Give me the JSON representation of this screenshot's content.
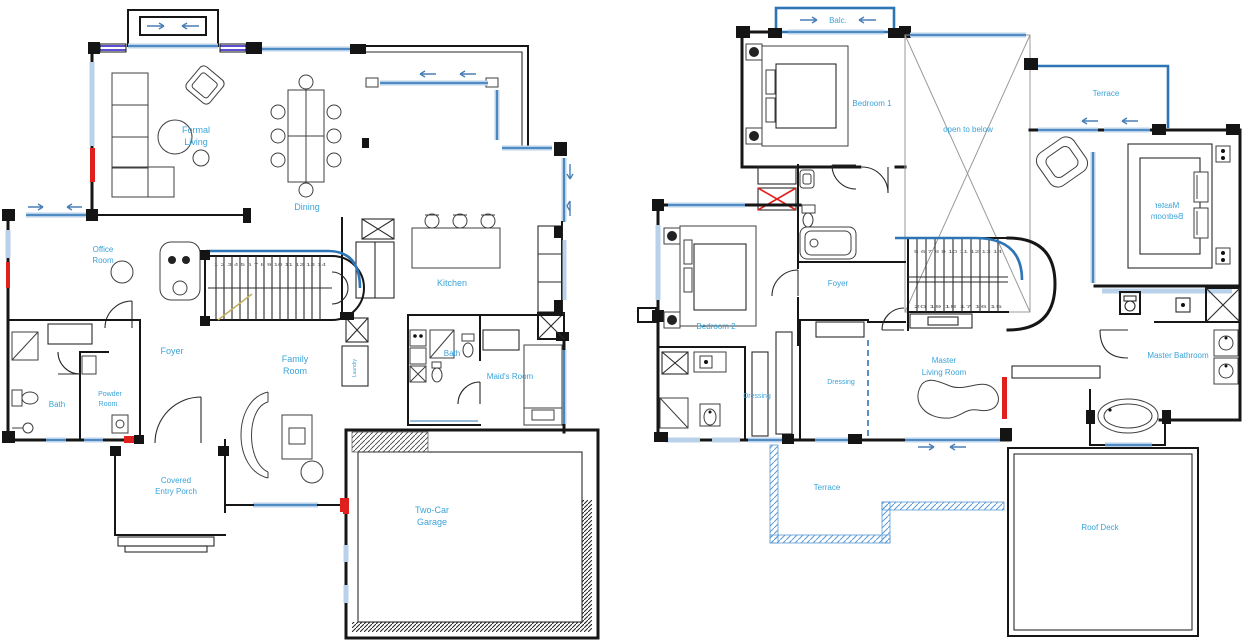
{
  "colors": {
    "wall": "#161616",
    "window_blue": "#2e75b6",
    "window_light": "#b9d2ea",
    "label_blue": "#3aa3d9",
    "accent_red": "#e0201c",
    "louver_violet": "#5a50d0",
    "rail_gold": "#c5b05a",
    "open_below_gray": "#9a9a9a"
  },
  "icons": {
    "arrow_right": "→",
    "arrow_left": "←",
    "arrow_up": "↑",
    "arrow_down": "↓",
    "washer": "washer-icon",
    "shaft_cross": "x-shaft-icon"
  },
  "ground_floor": {
    "labels": {
      "formal_living_1": "Formal",
      "formal_living_2": "Living",
      "dining": "Dining",
      "office_1": "Office",
      "office_2": "Room",
      "kitchen": "Kitchen",
      "foyer": "Foyer",
      "family_1": "Family",
      "family_2": "Room",
      "bath_left": "Bath",
      "powder_1": "Powder",
      "powder_2": "Room",
      "bath_mid": "Bath",
      "maids_room": "Maid's Room",
      "laundry": "Laundry",
      "porch_1": "Covered",
      "porch_2": "Entry Porch",
      "garage_1": "Two-Car",
      "garage_2": "Garage"
    },
    "stair_treads": "1 2 3 4 5 6 7 8 9 10 11 12 13 14"
  },
  "first_floor": {
    "labels": {
      "balcony": "Balc.",
      "bedroom1": "Bedroom 1",
      "open_to_below": "open to below",
      "terrace_top": "Terrace",
      "master_bed_1": "Master",
      "master_bed_2": "Bedroom",
      "bedroom2": "Bedroom 2",
      "foyer": "Foyer",
      "dressing_left": "Dressing",
      "dressing_right": "Dressing",
      "master_living_1": "Master",
      "master_living_2": "Living Room",
      "master_bathroom": "Master Bathroom",
      "terrace_bottom": "Terrace",
      "roof_deck": "Roof Deck"
    },
    "stair_treads_upper": "5 6 7 8 9 10 11 12 13 14",
    "stair_treads_lower": "20 19 18 17 16 15"
  }
}
